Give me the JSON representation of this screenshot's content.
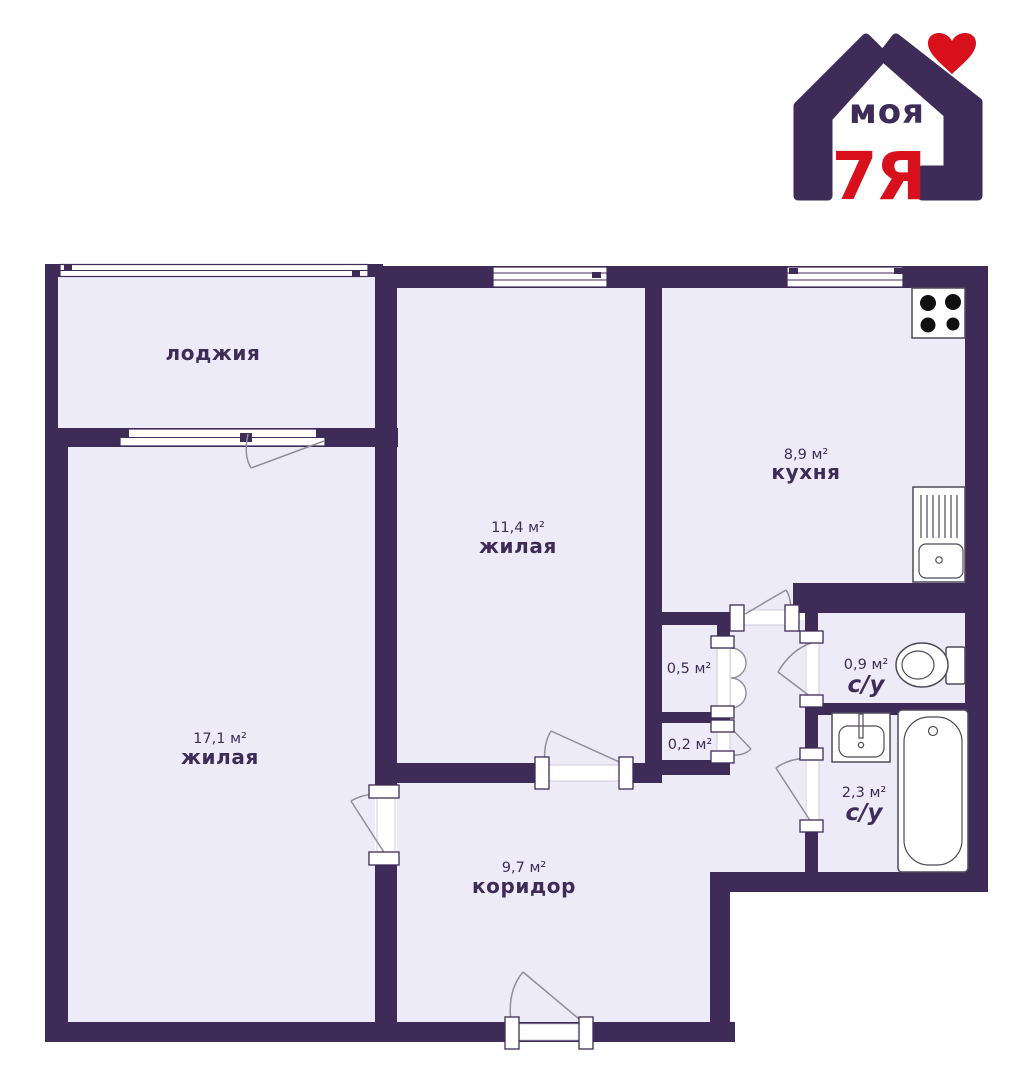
{
  "colors": {
    "wall": "#3e2b58",
    "floor": "#edebf7",
    "outside": "#ffffff",
    "doorline": "#8f8e9c",
    "fixline": "#4f4a5a",
    "burner": "#101010",
    "red": "#d8101c"
  },
  "logo": {
    "word": "моя",
    "mark": "7Я"
  },
  "rooms": {
    "loggia": {
      "name": "лоджия"
    },
    "living1": {
      "area": "11,4 м²",
      "name": "жилая"
    },
    "kitchen": {
      "area": "8,9 м²",
      "name": "кухня"
    },
    "living2": {
      "area": "17,1 м²",
      "name": "жилая"
    },
    "corridor": {
      "area": "9,7 м²",
      "name": "коридор"
    },
    "closet_05": {
      "area": "0,5 м²"
    },
    "closet_02": {
      "area": "0,2 м²"
    },
    "wc": {
      "area": "0,9 м²",
      "name": "с/у"
    },
    "bathroom": {
      "area": "2,3 м²",
      "name": "с/у"
    }
  }
}
